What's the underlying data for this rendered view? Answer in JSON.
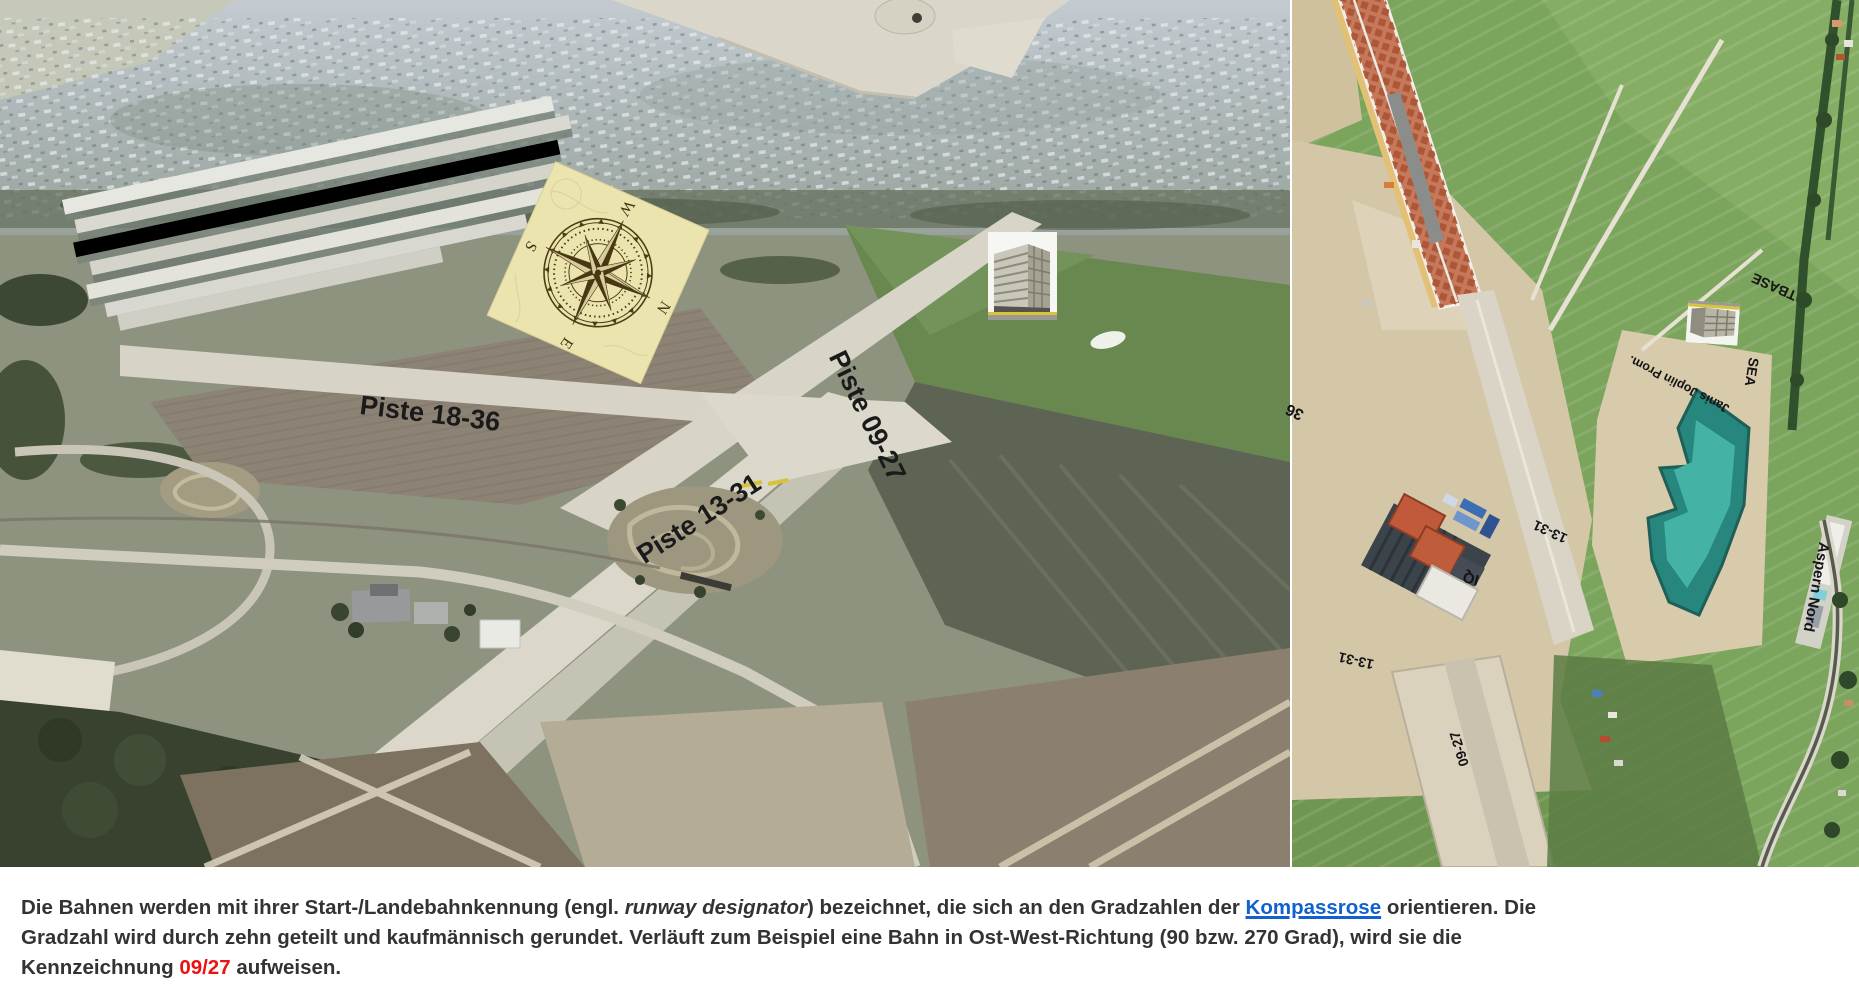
{
  "left_photo": {
    "description": "oblique aerial photo of former Aspern airfield with runway annotations",
    "labels": [
      {
        "id": "piste-18-36",
        "text": "Piste 18-36"
      },
      {
        "id": "piste-13-31",
        "text": "Piste 13-31"
      },
      {
        "id": "piste-09-27",
        "text": "Piste 09-27"
      }
    ],
    "compass": {
      "n": "N",
      "e": "E",
      "s": "S",
      "w": "W"
    }
  },
  "right_photo": {
    "description": "orthophoto of Seestadt Aspern construction site",
    "labels": [
      {
        "id": "rwy-36",
        "text": "36"
      },
      {
        "id": "rwy-13-31-a",
        "text": "13-31"
      },
      {
        "id": "rwy-13-31-b",
        "text": "13-31"
      },
      {
        "id": "rwy-09-27",
        "text": "09-27"
      },
      {
        "id": "iq",
        "text": "IQ"
      },
      {
        "id": "sea",
        "text": "SEA"
      },
      {
        "id": "tbase",
        "text": "TBASE"
      },
      {
        "id": "janis-joplin-prom",
        "text": "Janis Joplin Prom."
      },
      {
        "id": "aspern-nord",
        "text": "Aspern Nord"
      }
    ]
  },
  "caption": {
    "l1a": "Die Bahnen werden mit ihrer Start-/Landebahnkennung (engl. ",
    "l1_italic": "runway designator",
    "l1b": ") bezeichnet, die sich an den Gradzahlen der ",
    "l1_link": "Kompassrose",
    "l1c": " orientieren. Die",
    "l2": "Gradzahl wird durch zehn geteilt und kaufmännisch gerundet. Verläuft zum Beispiel eine Bahn in Ost-West-Richtung (90 bzw. 270 Grad), wird sie die",
    "l3a": "Kennzeichnung ",
    "l3_red": "09/27",
    "l3b": " aufweisen.",
    "colors": {
      "text": "#333333",
      "link": "#1161d1",
      "highlight": "#ee1111"
    }
  },
  "palette": {
    "lake_teal": "#2e9a90",
    "field_green": "#7ba45c",
    "construction_beige": "#d4c7a8",
    "runway_concrete": "#d7d4c7",
    "viaduct_red": "#c5795a",
    "compass_card": "#ece4ae"
  }
}
